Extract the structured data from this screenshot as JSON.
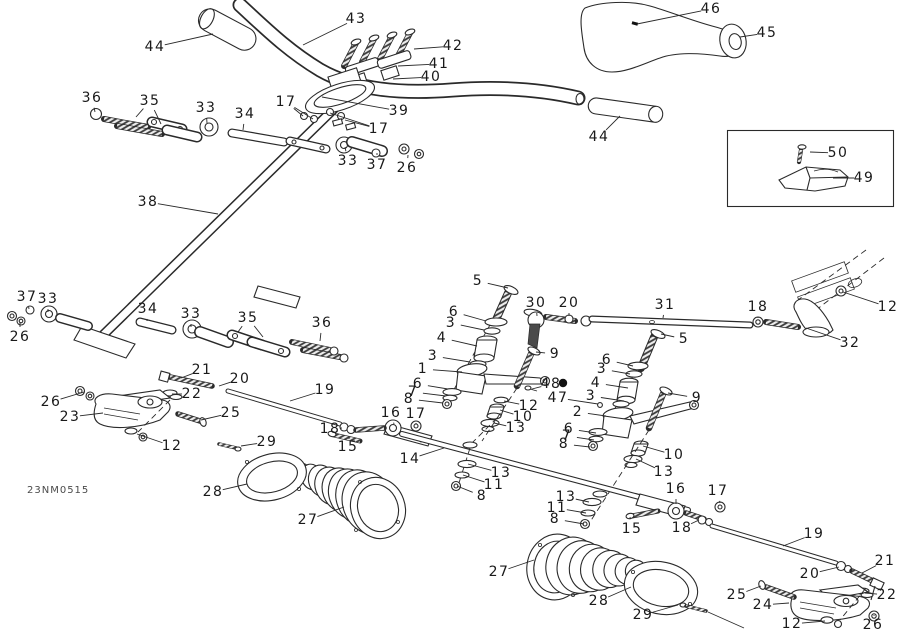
{
  "diagram": {
    "part_code": "23NM0515",
    "line_color": "#2a2a2a",
    "label_color": "#1a1a1a",
    "background": "#ffffff"
  },
  "callouts": [
    [
      "43",
      356,
      19,
      303,
      45
    ],
    [
      "44",
      155,
      47,
      213,
      34
    ],
    [
      "42",
      453,
      46,
      414,
      49
    ],
    [
      "41",
      439,
      64,
      398,
      66
    ],
    [
      "40",
      431,
      77,
      393,
      79
    ],
    [
      "39",
      399,
      111,
      322,
      97
    ],
    [
      "17",
      286,
      102,
      303,
      116,
      313,
      119
    ],
    [
      "17",
      379,
      129,
      345,
      120,
      330,
      113
    ],
    [
      "46",
      711,
      9,
      637,
      24
    ],
    [
      "45",
      767,
      33,
      740,
      37
    ],
    [
      "44",
      599,
      137,
      620,
      116
    ],
    [
      "50",
      838,
      153,
      810,
      152
    ],
    [
      "49",
      864,
      178,
      833,
      178
    ],
    [
      "36",
      92,
      98,
      95,
      112
    ],
    [
      "35",
      150,
      101,
      136,
      117,
      161,
      124
    ],
    [
      "33",
      206,
      108,
      207,
      123
    ],
    [
      "34",
      245,
      114,
      243,
      130
    ],
    [
      "33",
      348,
      161,
      345,
      147
    ],
    [
      "37",
      377,
      165,
      377,
      153
    ],
    [
      "26",
      407,
      168,
      408,
      155
    ],
    [
      "38",
      148,
      202,
      218,
      214
    ],
    [
      "37",
      27,
      297,
      29,
      309
    ],
    [
      "33",
      48,
      299,
      48,
      312
    ],
    [
      "26",
      20,
      337,
      20,
      322
    ],
    [
      "34",
      148,
      309,
      147,
      321
    ],
    [
      "33",
      191,
      314,
      191,
      327
    ],
    [
      "35",
      248,
      318,
      238,
      332,
      263,
      337
    ],
    [
      "36",
      322,
      323,
      320,
      341
    ],
    [
      "5",
      478,
      281,
      508,
      288
    ],
    [
      "30",
      536,
      303,
      537,
      316
    ],
    [
      "20",
      569,
      303,
      569,
      316
    ],
    [
      "31",
      665,
      305,
      663,
      318
    ],
    [
      "18",
      758,
      307,
      758,
      318
    ],
    [
      "12",
      888,
      307,
      843,
      292
    ],
    [
      "32",
      850,
      343,
      806,
      328
    ],
    [
      "5",
      684,
      339,
      661,
      334
    ],
    [
      "6",
      454,
      312,
      486,
      321
    ],
    [
      "3",
      451,
      323,
      484,
      330
    ],
    [
      "4",
      442,
      338,
      477,
      346
    ],
    [
      "3",
      433,
      356,
      470,
      362
    ],
    [
      "1",
      423,
      369,
      462,
      372
    ],
    [
      "6",
      418,
      384,
      448,
      389
    ],
    [
      "7",
      413,
      392,
      446,
      396
    ],
    [
      "8",
      409,
      399,
      443,
      403
    ],
    [
      "9",
      555,
      354,
      536,
      352
    ],
    [
      "48",
      551,
      384,
      532,
      389
    ],
    [
      "47",
      558,
      398,
      598,
      404
    ],
    [
      "12",
      529,
      406,
      504,
      401
    ],
    [
      "10",
      523,
      417,
      500,
      410
    ],
    [
      "13",
      516,
      428,
      494,
      423
    ],
    [
      "16",
      391,
      413,
      394,
      424
    ],
    [
      "17",
      416,
      414,
      416,
      423
    ],
    [
      "19",
      325,
      390,
      290,
      401
    ],
    [
      "18",
      330,
      429,
      342,
      428
    ],
    [
      "15",
      348,
      447,
      349,
      439
    ],
    [
      "14",
      410,
      459,
      444,
      448
    ],
    [
      "6",
      607,
      360,
      633,
      366
    ],
    [
      "3",
      602,
      369,
      630,
      374
    ],
    [
      "4",
      596,
      383,
      628,
      388
    ],
    [
      "3",
      591,
      396,
      624,
      401
    ],
    [
      "2",
      578,
      412,
      606,
      416
    ],
    [
      "6",
      569,
      429,
      596,
      433
    ],
    [
      "7",
      567,
      436,
      594,
      440
    ],
    [
      "8",
      564,
      444,
      590,
      447
    ],
    [
      "9",
      697,
      398,
      668,
      393
    ],
    [
      "10",
      674,
      455,
      643,
      446
    ],
    [
      "13",
      664,
      472,
      636,
      459
    ],
    [
      "13",
      501,
      473,
      468,
      464
    ],
    [
      "11",
      494,
      485,
      463,
      475
    ],
    [
      "8",
      482,
      496,
      457,
      486
    ],
    [
      "13",
      566,
      497,
      589,
      502
    ],
    [
      "11",
      557,
      508,
      586,
      513
    ],
    [
      "8",
      555,
      519,
      584,
      524
    ],
    [
      "16",
      676,
      489,
      676,
      504
    ],
    [
      "17",
      718,
      491,
      720,
      503
    ],
    [
      "15",
      632,
      529,
      630,
      517
    ],
    [
      "18",
      682,
      528,
      699,
      520
    ],
    [
      "21",
      202,
      370,
      181,
      378
    ],
    [
      "20",
      240,
      379,
      219,
      386
    ],
    [
      "22",
      192,
      394,
      172,
      394
    ],
    [
      "26",
      51,
      402,
      84,
      392
    ],
    [
      "23",
      70,
      417,
      103,
      413
    ],
    [
      "25",
      231,
      413,
      201,
      420
    ],
    [
      "12",
      172,
      446,
      137,
      434
    ],
    [
      "29",
      267,
      442,
      241,
      446
    ],
    [
      "28",
      213,
      492,
      247,
      484
    ],
    [
      "27",
      308,
      520,
      344,
      507
    ],
    [
      "27",
      499,
      572,
      534,
      560
    ],
    [
      "28",
      599,
      601,
      631,
      587
    ],
    [
      "29",
      643,
      615,
      678,
      605
    ],
    [
      "19",
      814,
      534,
      783,
      546
    ],
    [
      "20",
      810,
      574,
      839,
      567
    ],
    [
      "21",
      885,
      561,
      862,
      573
    ],
    [
      "22",
      887,
      595,
      865,
      593
    ],
    [
      "25",
      737,
      595,
      761,
      586
    ],
    [
      "24",
      763,
      605,
      789,
      603
    ],
    [
      "12",
      792,
      624,
      825,
      621
    ],
    [
      "26",
      873,
      625,
      874,
      616
    ]
  ]
}
